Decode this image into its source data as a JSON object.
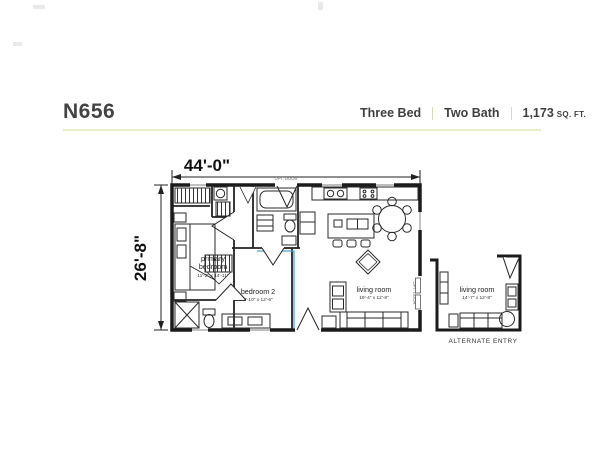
{
  "header": {
    "model": "N656",
    "spec_bed": "Three Bed",
    "spec_bath": "Two Bath",
    "sqft_value": "1,173",
    "sqft_unit": "SQ. FT.",
    "accent_rule_color": "#e9edc9"
  },
  "dimensions": {
    "width": "44'-0\"",
    "depth": "26'-8\""
  },
  "rooms": {
    "primary_bedroom": {
      "name1": "primary",
      "name2": "bedroom",
      "dims": "11'-2\" x 14'-11\""
    },
    "bedroom2": {
      "name": "bedroom 2",
      "dims": "7'-10\" x 12'-6\""
    },
    "living_room": {
      "name": "living room",
      "dims": "19'-4\" x 12'-8\""
    }
  },
  "annotations": {
    "opt_door_top": "OPT. DOOR",
    "opt_door_side": "OPT. DOOR"
  },
  "alternate": {
    "living_room": {
      "name": "living room",
      "dims": "14'-7\" x 12'-8\""
    },
    "caption": "ALTERNATE ENTRY"
  },
  "colors": {
    "walls": "#1b1b1b",
    "marriage_line": "#4ba7c8"
  }
}
